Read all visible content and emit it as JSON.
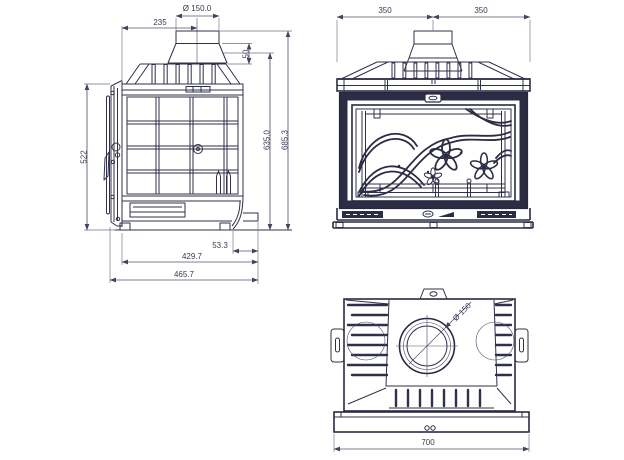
{
  "drawing": {
    "background": "#ffffff",
    "line_color": "#30304a",
    "heavy_line_color": "#2c2c44",
    "dimension_color": "#55556e",
    "views": {
      "side": {
        "title": "side-view",
        "dims": {
          "flue_diameter": "Ø 150.0",
          "flue_center_offset": "235",
          "collar_height": "50",
          "door_height": "522",
          "body_height": "635.0",
          "overall_height": "685.3",
          "rear_offset": "53.3",
          "body_depth": "429.7",
          "overall_depth": "465.7"
        }
      },
      "front": {
        "title": "front-view",
        "dims": {
          "left_half_width": "350",
          "right_half_width": "350"
        }
      },
      "top": {
        "title": "top-view",
        "dims": {
          "flue_diameter": "Ø 150",
          "overall_width": "700"
        }
      }
    }
  }
}
